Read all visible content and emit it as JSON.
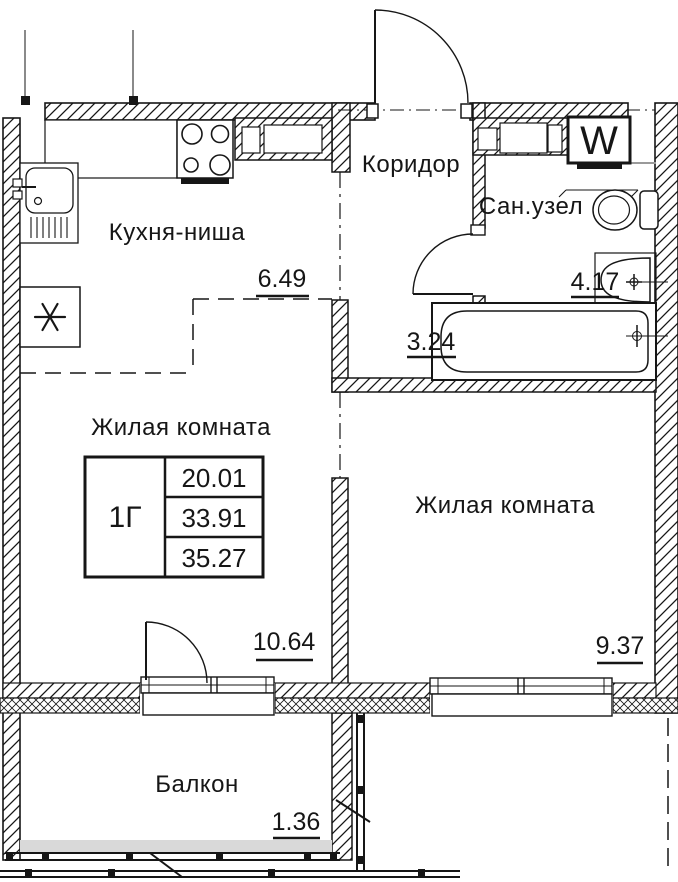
{
  "plan": {
    "unit_type": "1Г",
    "areas": [
      "20.01",
      "33.91",
      "35.27"
    ],
    "washer_label": "W",
    "rooms": [
      {
        "label": "Кухня-ниша",
        "area": "6.49"
      },
      {
        "label": "Коридор",
        "area": "3.24"
      },
      {
        "label": "Сан.узел",
        "area": "4.17"
      },
      {
        "label": "Жилая комната",
        "area": "10.64"
      },
      {
        "label": "Жилая комната",
        "area": "9.37"
      },
      {
        "label": "Балкон",
        "area": "1.36"
      }
    ],
    "colors": {
      "line": "#161616",
      "gray": "#9a9a9a",
      "light_gray": "#d9d9d9",
      "bg": "#ffffff"
    }
  }
}
